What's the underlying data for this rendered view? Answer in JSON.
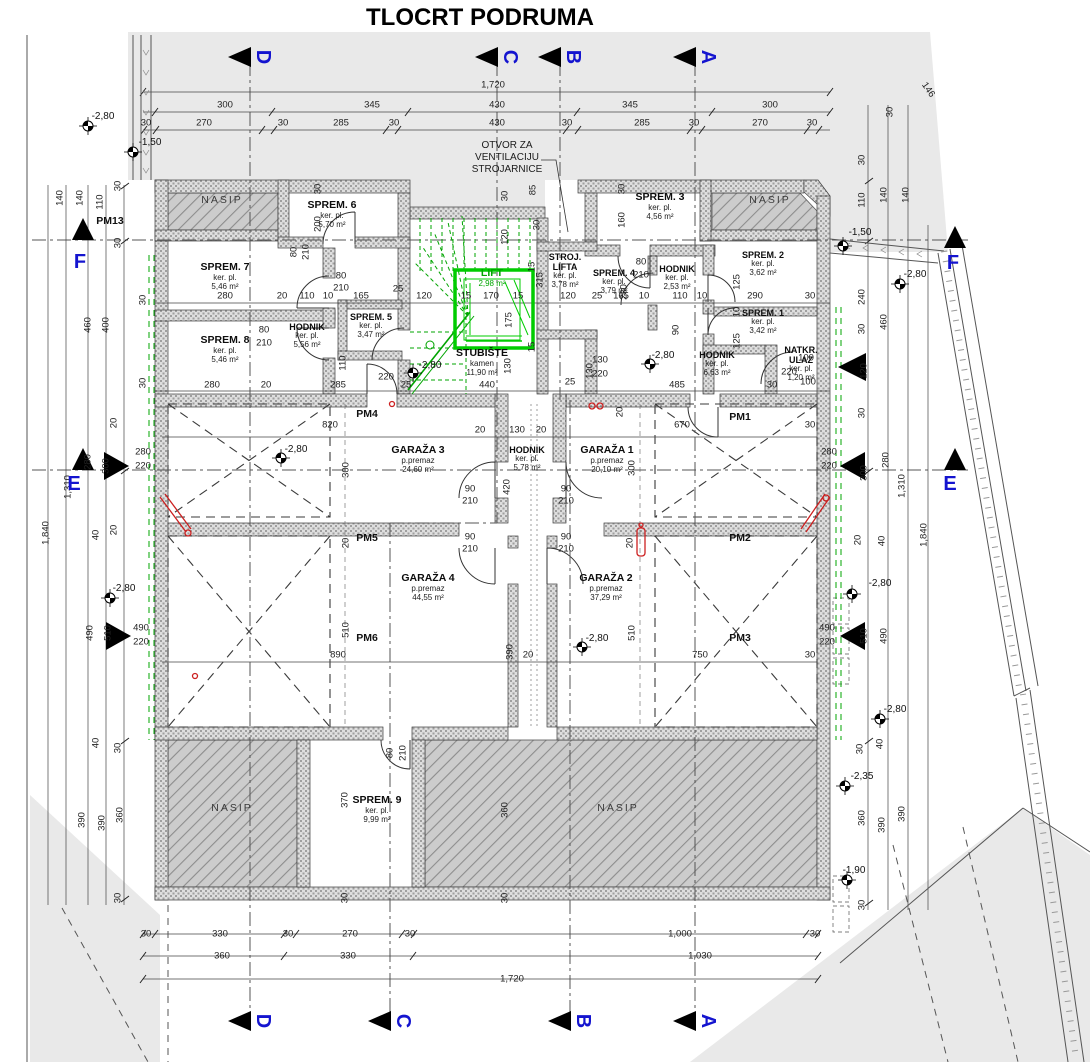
{
  "title": "TLOCRT PODRUMA",
  "colors": {
    "section_blue": "#1414cf",
    "stair_green": "#00a400",
    "alert_red": "#cc2020",
    "terrain_grey": "#e9e9e9"
  },
  "annotation": {
    "l1": "OTVOR ZA",
    "l2": "VENTILACIJU",
    "l3": "STROJARNICE"
  },
  "rooms": [
    {
      "name": "SPREM. 6",
      "finish": "ker. pl.",
      "area": "5,70 m²",
      "x": 332,
      "y": 200
    },
    {
      "name": "SPREM. 7",
      "finish": "ker. pl.",
      "area": "5,46 m²",
      "x": 225,
      "y": 262
    },
    {
      "name": "SPREM. 8",
      "finish": "ker. pl.",
      "area": "5,46 m²",
      "x": 225,
      "y": 335
    },
    {
      "name": "HODNIK",
      "finish": "ker. pl.",
      "area": "5,56 m²",
      "x": 307,
      "y": 322,
      "cls": "tiny"
    },
    {
      "name": "SPREM. 5",
      "finish": "ker. pl.",
      "area": "3,47 m²",
      "x": 371,
      "y": 312,
      "cls": "tiny"
    },
    {
      "name": "STROJ. LIFTA",
      "finish": "ker. pl.",
      "area": "3,78 m²",
      "x": 565,
      "y": 252,
      "cls": "tiny narrow"
    },
    {
      "name": "LIFT",
      "finish": "",
      "area": "2,98 m²",
      "x": 492,
      "y": 268,
      "cls": "lift"
    },
    {
      "name": "SPREM. 4",
      "finish": "ker. pl.",
      "area": "3,79 m²",
      "x": 614,
      "y": 268,
      "cls": "tiny narrow"
    },
    {
      "name": "HODNIK",
      "finish": "ker. pl.",
      "area": "2,53 m²",
      "x": 677,
      "y": 264,
      "cls": "tiny"
    },
    {
      "name": "SPREM. 3",
      "finish": "ker. pl.",
      "area": "4,56 m²",
      "x": 660,
      "y": 192
    },
    {
      "name": "SPREM. 2",
      "finish": "ker. pl.",
      "area": "3,62 m²",
      "x": 763,
      "y": 250,
      "cls": "tiny"
    },
    {
      "name": "SPREM. 1",
      "finish": "ker. pl.",
      "area": "3,42 m²",
      "x": 763,
      "y": 308,
      "cls": "tiny"
    },
    {
      "name": "HODNIK",
      "finish": "ker. pl.",
      "area": "6,63 m²",
      "x": 717,
      "y": 350,
      "cls": "tiny"
    },
    {
      "name": "NATKR. ULAZ",
      "finish": "ker. pl.",
      "area": "1,20 m²",
      "x": 801,
      "y": 345,
      "cls": "tiny narrow"
    },
    {
      "name": "STUBIŠTE",
      "finish": "kamen",
      "area": "11,90 m²",
      "x": 482,
      "y": 348
    },
    {
      "name": "GARAŽA 3",
      "finish": "p.premaz",
      "area": "24,60 m²",
      "x": 418,
      "y": 445
    },
    {
      "name": "HODNIK",
      "finish": "ker. pl.",
      "area": "5,78 m²",
      "x": 527,
      "y": 445,
      "cls": "tiny"
    },
    {
      "name": "GARAŽA 1",
      "finish": "p.premaz",
      "area": "20,10 m²",
      "x": 607,
      "y": 445
    },
    {
      "name": "GARAŽA 4",
      "finish": "p.premaz",
      "area": "44,55 m²",
      "x": 428,
      "y": 573
    },
    {
      "name": "GARAŽA 2",
      "finish": "p.premaz",
      "area": "37,29 m²",
      "x": 606,
      "y": 573
    },
    {
      "name": "SPREM. 9",
      "finish": "ker. pl.",
      "area": "9,99 m²",
      "x": 377,
      "y": 795
    }
  ],
  "zones": [
    {
      "t": "NASIP",
      "x": 222,
      "y": 200,
      "cls": "zone"
    },
    {
      "t": "NASIP",
      "x": 770,
      "y": 200,
      "cls": "zone"
    },
    {
      "t": "NASIP",
      "x": 232,
      "y": 808,
      "cls": "zone"
    },
    {
      "t": "NASIP",
      "x": 618,
      "y": 808,
      "cls": "zone"
    },
    {
      "t": "PM4",
      "x": 367,
      "y": 414,
      "cls": "pm"
    },
    {
      "t": "PM5",
      "x": 367,
      "y": 538,
      "cls": "pm"
    },
    {
      "t": "PM6",
      "x": 367,
      "y": 638,
      "cls": "pm"
    },
    {
      "t": "PM1",
      "x": 740,
      "y": 417,
      "cls": "pm"
    },
    {
      "t": "PM2",
      "x": 740,
      "y": 538,
      "cls": "pm"
    },
    {
      "t": "PM3",
      "x": 740,
      "y": 638,
      "cls": "pm"
    },
    {
      "t": "PM13",
      "x": 110,
      "y": 221,
      "cls": "pm"
    }
  ],
  "levels": [
    {
      "t": "-2,80",
      "x": 103,
      "y": 117
    },
    {
      "t": "-1,50",
      "x": 150,
      "y": 143
    },
    {
      "t": "-2,80",
      "x": 430,
      "y": 366
    },
    {
      "t": "-2,80",
      "x": 296,
      "y": 450
    },
    {
      "t": "-2,80",
      "x": 597,
      "y": 639
    },
    {
      "t": "-2,80",
      "x": 663,
      "y": 356
    },
    {
      "t": "-2,80",
      "x": 124,
      "y": 589
    },
    {
      "t": "-1,50",
      "x": 860,
      "y": 233
    },
    {
      "t": "-2,80",
      "x": 915,
      "y": 275
    },
    {
      "t": "-2,80",
      "x": 880,
      "y": 584
    },
    {
      "t": "-2,80",
      "x": 895,
      "y": 710
    },
    {
      "t": "-2,35",
      "x": 862,
      "y": 777
    },
    {
      "t": "-1,90",
      "x": 854,
      "y": 871
    }
  ],
  "dims_h": [
    {
      "t": "1,720",
      "x": 493,
      "y": 85
    },
    {
      "t": "300",
      "x": 225,
      "y": 105
    },
    {
      "t": "345",
      "x": 372,
      "y": 105
    },
    {
      "t": "430",
      "x": 497,
      "y": 105
    },
    {
      "t": "345",
      "x": 630,
      "y": 105
    },
    {
      "t": "300",
      "x": 770,
      "y": 105
    },
    {
      "t": "30",
      "x": 146,
      "y": 123
    },
    {
      "t": "270",
      "x": 204,
      "y": 123
    },
    {
      "t": "30",
      "x": 283,
      "y": 123
    },
    {
      "t": "285",
      "x": 341,
      "y": 123
    },
    {
      "t": "30",
      "x": 394,
      "y": 123
    },
    {
      "t": "430",
      "x": 497,
      "y": 123
    },
    {
      "t": "30",
      "x": 567,
      "y": 123
    },
    {
      "t": "285",
      "x": 642,
      "y": 123
    },
    {
      "t": "30",
      "x": 694,
      "y": 123
    },
    {
      "t": "270",
      "x": 760,
      "y": 123
    },
    {
      "t": "30",
      "x": 812,
      "y": 123
    },
    {
      "t": "280",
      "x": 225,
      "y": 296
    },
    {
      "t": "20",
      "x": 282,
      "y": 296
    },
    {
      "t": "110",
      "x": 307,
      "y": 296
    },
    {
      "t": "10",
      "x": 328,
      "y": 296
    },
    {
      "t": "165",
      "x": 361,
      "y": 296
    },
    {
      "t": "25",
      "x": 398,
      "y": 289
    },
    {
      "t": "120",
      "x": 424,
      "y": 296
    },
    {
      "t": "15",
      "x": 466,
      "y": 296
    },
    {
      "t": "170",
      "x": 491,
      "y": 296
    },
    {
      "t": "15",
      "x": 518,
      "y": 296
    },
    {
      "t": "120",
      "x": 568,
      "y": 296
    },
    {
      "t": "25",
      "x": 597,
      "y": 296
    },
    {
      "t": "165",
      "x": 621,
      "y": 296
    },
    {
      "t": "10",
      "x": 644,
      "y": 296
    },
    {
      "t": "110",
      "x": 680,
      "y": 296
    },
    {
      "t": "10",
      "x": 702,
      "y": 296
    },
    {
      "t": "290",
      "x": 755,
      "y": 296
    },
    {
      "t": "30",
      "x": 810,
      "y": 296
    },
    {
      "t": "80",
      "x": 341,
      "y": 276
    },
    {
      "t": "210",
      "x": 341,
      "y": 288
    },
    {
      "t": "80",
      "x": 264,
      "y": 330
    },
    {
      "t": "210",
      "x": 264,
      "y": 343
    },
    {
      "t": "80",
      "x": 641,
      "y": 262
    },
    {
      "t": "210",
      "x": 641,
      "y": 275
    },
    {
      "t": "100",
      "x": 806,
      "y": 358
    },
    {
      "t": "220",
      "x": 789,
      "y": 372
    },
    {
      "t": "100",
      "x": 808,
      "y": 382
    },
    {
      "t": "130",
      "x": 600,
      "y": 360
    },
    {
      "t": "220",
      "x": 600,
      "y": 374
    },
    {
      "t": "25",
      "x": 570,
      "y": 382
    },
    {
      "t": "280",
      "x": 212,
      "y": 385
    },
    {
      "t": "20",
      "x": 266,
      "y": 385
    },
    {
      "t": "285",
      "x": 338,
      "y": 385
    },
    {
      "t": "220",
      "x": 386,
      "y": 377
    },
    {
      "t": "25",
      "x": 406,
      "y": 385
    },
    {
      "t": "440",
      "x": 487,
      "y": 385
    },
    {
      "t": "485",
      "x": 677,
      "y": 385
    },
    {
      "t": "30",
      "x": 772,
      "y": 385
    },
    {
      "t": "90",
      "x": 470,
      "y": 489
    },
    {
      "t": "210",
      "x": 470,
      "y": 501
    },
    {
      "t": "90",
      "x": 470,
      "y": 537
    },
    {
      "t": "210",
      "x": 470,
      "y": 549
    },
    {
      "t": "90",
      "x": 566,
      "y": 489
    },
    {
      "t": "210",
      "x": 566,
      "y": 501
    },
    {
      "t": "90",
      "x": 566,
      "y": 537
    },
    {
      "t": "210",
      "x": 566,
      "y": 549
    },
    {
      "t": "820",
      "x": 330,
      "y": 425
    },
    {
      "t": "20",
      "x": 480,
      "y": 430
    },
    {
      "t": "130",
      "x": 517,
      "y": 430
    },
    {
      "t": "20",
      "x": 541,
      "y": 430
    },
    {
      "t": "670",
      "x": 682,
      "y": 425
    },
    {
      "t": "30",
      "x": 810,
      "y": 425
    },
    {
      "t": "890",
      "x": 338,
      "y": 655
    },
    {
      "t": "20",
      "x": 528,
      "y": 655
    },
    {
      "t": "750",
      "x": 700,
      "y": 655
    },
    {
      "t": "30",
      "x": 810,
      "y": 655
    },
    {
      "t": "30",
      "x": 146,
      "y": 934
    },
    {
      "t": "330",
      "x": 220,
      "y": 934
    },
    {
      "t": "30",
      "x": 288,
      "y": 934
    },
    {
      "t": "270",
      "x": 350,
      "y": 934
    },
    {
      "t": "30",
      "x": 410,
      "y": 934
    },
    {
      "t": "1,000",
      "x": 680,
      "y": 934
    },
    {
      "t": "30",
      "x": 815,
      "y": 934
    },
    {
      "t": "360",
      "x": 222,
      "y": 956
    },
    {
      "t": "330",
      "x": 348,
      "y": 956
    },
    {
      "t": "1,030",
      "x": 700,
      "y": 956
    },
    {
      "t": "1,720",
      "x": 512,
      "y": 979
    },
    {
      "t": "280",
      "x": 143,
      "y": 452
    },
    {
      "t": "220",
      "x": 143,
      "y": 466
    },
    {
      "t": "490",
      "x": 141,
      "y": 628
    },
    {
      "t": "220",
      "x": 141,
      "y": 642
    },
    {
      "t": "280",
      "x": 829,
      "y": 452
    },
    {
      "t": "220",
      "x": 829,
      "y": 466
    },
    {
      "t": "490",
      "x": 827,
      "y": 628
    },
    {
      "t": "220",
      "x": 827,
      "y": 642
    }
  ],
  "dims_v": [
    {
      "t": "140",
      "x": 60,
      "y": 198
    },
    {
      "t": "140",
      "x": 80,
      "y": 198
    },
    {
      "t": "110",
      "x": 100,
      "y": 202
    },
    {
      "t": "30",
      "x": 118,
      "y": 186
    },
    {
      "t": "30",
      "x": 118,
      "y": 243
    },
    {
      "t": "460",
      "x": 88,
      "y": 325
    },
    {
      "t": "400",
      "x": 106,
      "y": 325
    },
    {
      "t": "20",
      "x": 114,
      "y": 423
    },
    {
      "t": "280",
      "x": 88,
      "y": 462
    },
    {
      "t": "300",
      "x": 106,
      "y": 466
    },
    {
      "t": "1,310",
      "x": 68,
      "y": 487
    },
    {
      "t": "1,840",
      "x": 46,
      "y": 533
    },
    {
      "t": "40",
      "x": 96,
      "y": 535
    },
    {
      "t": "20",
      "x": 114,
      "y": 530
    },
    {
      "t": "490",
      "x": 90,
      "y": 633
    },
    {
      "t": "510",
      "x": 108,
      "y": 633
    },
    {
      "t": "40",
      "x": 96,
      "y": 743
    },
    {
      "t": "30",
      "x": 118,
      "y": 748
    },
    {
      "t": "390",
      "x": 82,
      "y": 820
    },
    {
      "t": "390",
      "x": 102,
      "y": 823
    },
    {
      "t": "360",
      "x": 120,
      "y": 815
    },
    {
      "t": "30",
      "x": 118,
      "y": 898
    },
    {
      "t": "30",
      "x": 143,
      "y": 300
    },
    {
      "t": "30",
      "x": 143,
      "y": 383
    },
    {
      "t": "30",
      "x": 890,
      "y": 112
    },
    {
      "t": "110",
      "x": 862,
      "y": 200
    },
    {
      "t": "140",
      "x": 884,
      "y": 195
    },
    {
      "t": "140",
      "x": 906,
      "y": 195
    },
    {
      "t": "30",
      "x": 862,
      "y": 160
    },
    {
      "t": "240",
      "x": 862,
      "y": 297
    },
    {
      "t": "460",
      "x": 884,
      "y": 322
    },
    {
      "t": "30",
      "x": 862,
      "y": 329
    },
    {
      "t": "120",
      "x": 864,
      "y": 371
    },
    {
      "t": "30",
      "x": 862,
      "y": 413
    },
    {
      "t": "280",
      "x": 886,
      "y": 460
    },
    {
      "t": "300",
      "x": 864,
      "y": 473
    },
    {
      "t": "1,310",
      "x": 902,
      "y": 486
    },
    {
      "t": "1,840",
      "x": 924,
      "y": 535
    },
    {
      "t": "20",
      "x": 858,
      "y": 540
    },
    {
      "t": "40",
      "x": 882,
      "y": 541
    },
    {
      "t": "510",
      "x": 864,
      "y": 636
    },
    {
      "t": "490",
      "x": 884,
      "y": 636
    },
    {
      "t": "30",
      "x": 860,
      "y": 749
    },
    {
      "t": "40",
      "x": 880,
      "y": 744
    },
    {
      "t": "360",
      "x": 862,
      "y": 818
    },
    {
      "t": "390",
      "x": 882,
      "y": 825
    },
    {
      "t": "390",
      "x": 902,
      "y": 814
    },
    {
      "t": "30",
      "x": 862,
      "y": 905
    },
    {
      "t": "30",
      "x": 318,
      "y": 189
    },
    {
      "t": "200",
      "x": 318,
      "y": 224
    },
    {
      "t": "30",
      "x": 622,
      "y": 189
    },
    {
      "t": "160",
      "x": 622,
      "y": 220
    },
    {
      "t": "230",
      "x": 624,
      "y": 292
    },
    {
      "t": "110",
      "x": 343,
      "y": 363
    },
    {
      "t": "30",
      "x": 505,
      "y": 196
    },
    {
      "t": "85",
      "x": 533,
      "y": 190
    },
    {
      "t": "120",
      "x": 505,
      "y": 237
    },
    {
      "t": "30",
      "x": 537,
      "y": 225
    },
    {
      "t": "315",
      "x": 540,
      "y": 280
    },
    {
      "t": "15",
      "x": 532,
      "y": 267
    },
    {
      "t": "175",
      "x": 509,
      "y": 320
    },
    {
      "t": "15",
      "x": 532,
      "y": 347
    },
    {
      "t": "130",
      "x": 508,
      "y": 366
    },
    {
      "t": "125",
      "x": 737,
      "y": 282
    },
    {
      "t": "10",
      "x": 737,
      "y": 312
    },
    {
      "t": "125",
      "x": 737,
      "y": 341
    },
    {
      "t": "90",
      "x": 676,
      "y": 330
    },
    {
      "t": "130",
      "x": 590,
      "y": 371
    },
    {
      "t": "20",
      "x": 620,
      "y": 412
    },
    {
      "t": "300",
      "x": 632,
      "y": 468
    },
    {
      "t": "300",
      "x": 346,
      "y": 470
    },
    {
      "t": "420",
      "x": 507,
      "y": 487
    },
    {
      "t": "20",
      "x": 346,
      "y": 543
    },
    {
      "t": "20",
      "x": 630,
      "y": 543
    },
    {
      "t": "510",
      "x": 346,
      "y": 630
    },
    {
      "t": "510",
      "x": 632,
      "y": 633
    },
    {
      "t": "390",
      "x": 510,
      "y": 652
    },
    {
      "t": "370",
      "x": 345,
      "y": 800
    },
    {
      "t": "360",
      "x": 505,
      "y": 810
    },
    {
      "t": "30",
      "x": 345,
      "y": 898
    },
    {
      "t": "30",
      "x": 505,
      "y": 898
    },
    {
      "t": "80",
      "x": 294,
      "y": 252
    },
    {
      "t": "210",
      "x": 306,
      "y": 252
    },
    {
      "t": "80",
      "x": 390,
      "y": 753
    },
    {
      "t": "210",
      "x": 403,
      "y": 753
    }
  ],
  "dims_o": [
    {
      "t": "146",
      "x": 928,
      "y": 90,
      "rot": 55
    }
  ],
  "sec_top": [
    {
      "t": "D",
      "x": 263,
      "y": 57,
      "cls": "rot"
    },
    {
      "t": "C",
      "x": 510,
      "y": 57,
      "cls": "rot"
    },
    {
      "t": "B",
      "x": 573,
      "y": 57,
      "cls": "rot"
    },
    {
      "t": "A",
      "x": 708,
      "y": 57,
      "cls": "rot"
    }
  ],
  "sec_bottom": [
    {
      "t": "D",
      "x": 263,
      "y": 1021,
      "cls": "rot"
    },
    {
      "t": "C",
      "x": 403,
      "y": 1021,
      "cls": "rot"
    },
    {
      "t": "B",
      "x": 583,
      "y": 1021,
      "cls": "rot"
    },
    {
      "t": "A",
      "x": 708,
      "y": 1021,
      "cls": "rot"
    }
  ],
  "sec_left": [
    {
      "t": "F",
      "x": 80,
      "y": 262
    },
    {
      "t": "E",
      "x": 74,
      "y": 484
    }
  ],
  "sec_right": [
    {
      "t": "F",
      "x": 953,
      "y": 263
    },
    {
      "t": "E",
      "x": 950,
      "y": 484
    }
  ]
}
